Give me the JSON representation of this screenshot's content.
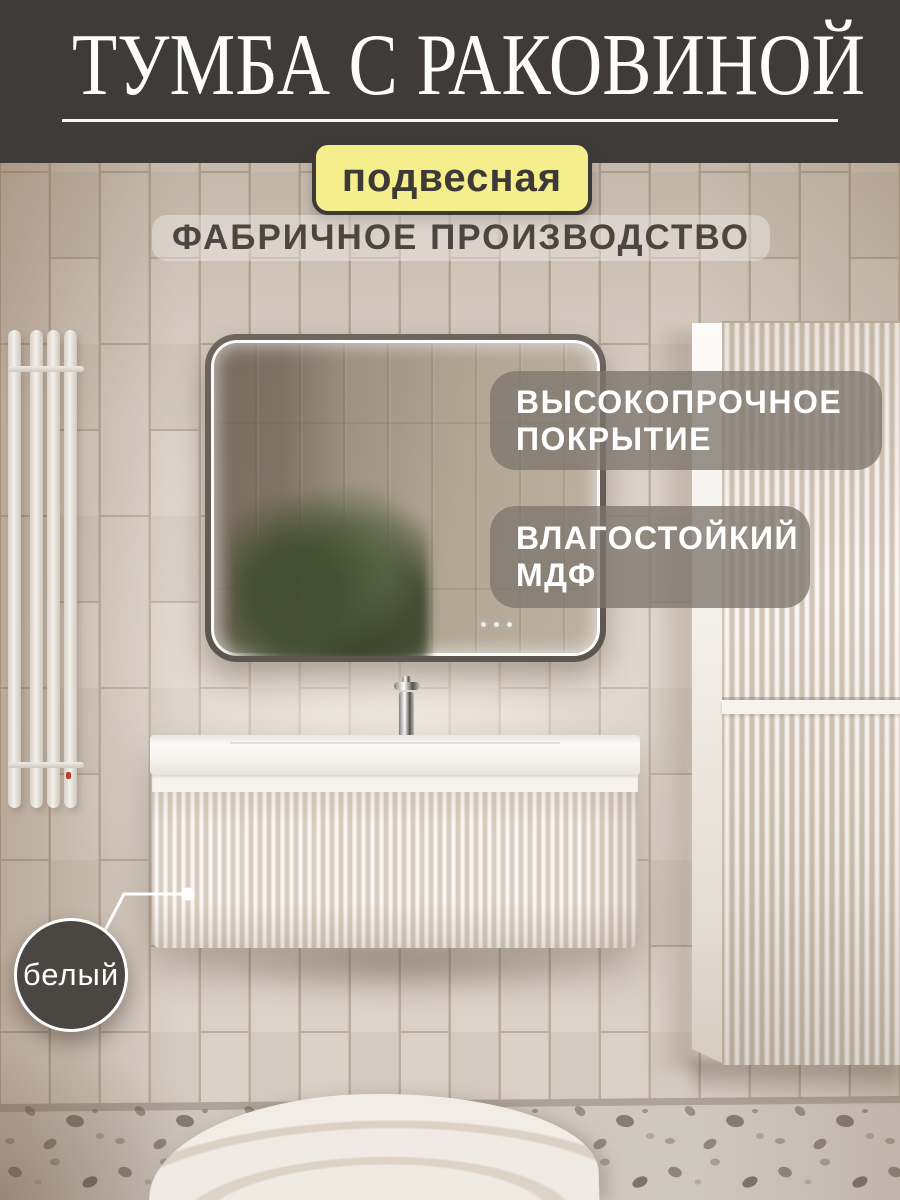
{
  "header": {
    "title": "ТУМБА С РАКОВИНОЙ"
  },
  "mount_tag": {
    "label": "подвесная"
  },
  "subtitle": {
    "label": "ФАБРИЧНОЕ ПРОИЗВОДСТВО"
  },
  "features": [
    {
      "line1": "ВЫСОКОПРОЧНОЕ",
      "line2": "ПОКРЫТИЕ"
    },
    {
      "line1": "ВЛАГОСТОЙКИЙ",
      "line2": "МДФ"
    }
  ],
  "color_callout": {
    "label": "белый"
  },
  "palette": {
    "header_bg": "#3F3B38",
    "accent_yellow": "#F4EF8C",
    "feature_badge_bg": "#7E766D",
    "text_dark": "#4B4642",
    "text_light": "#FFFFFF",
    "wall_tile": "#D8CFC5",
    "tile_grout": "#B9AC9E",
    "furniture_white": "#F6F3EE",
    "floor_terrazzo": "#CFC8C0",
    "plant_green": "#5D684A"
  }
}
